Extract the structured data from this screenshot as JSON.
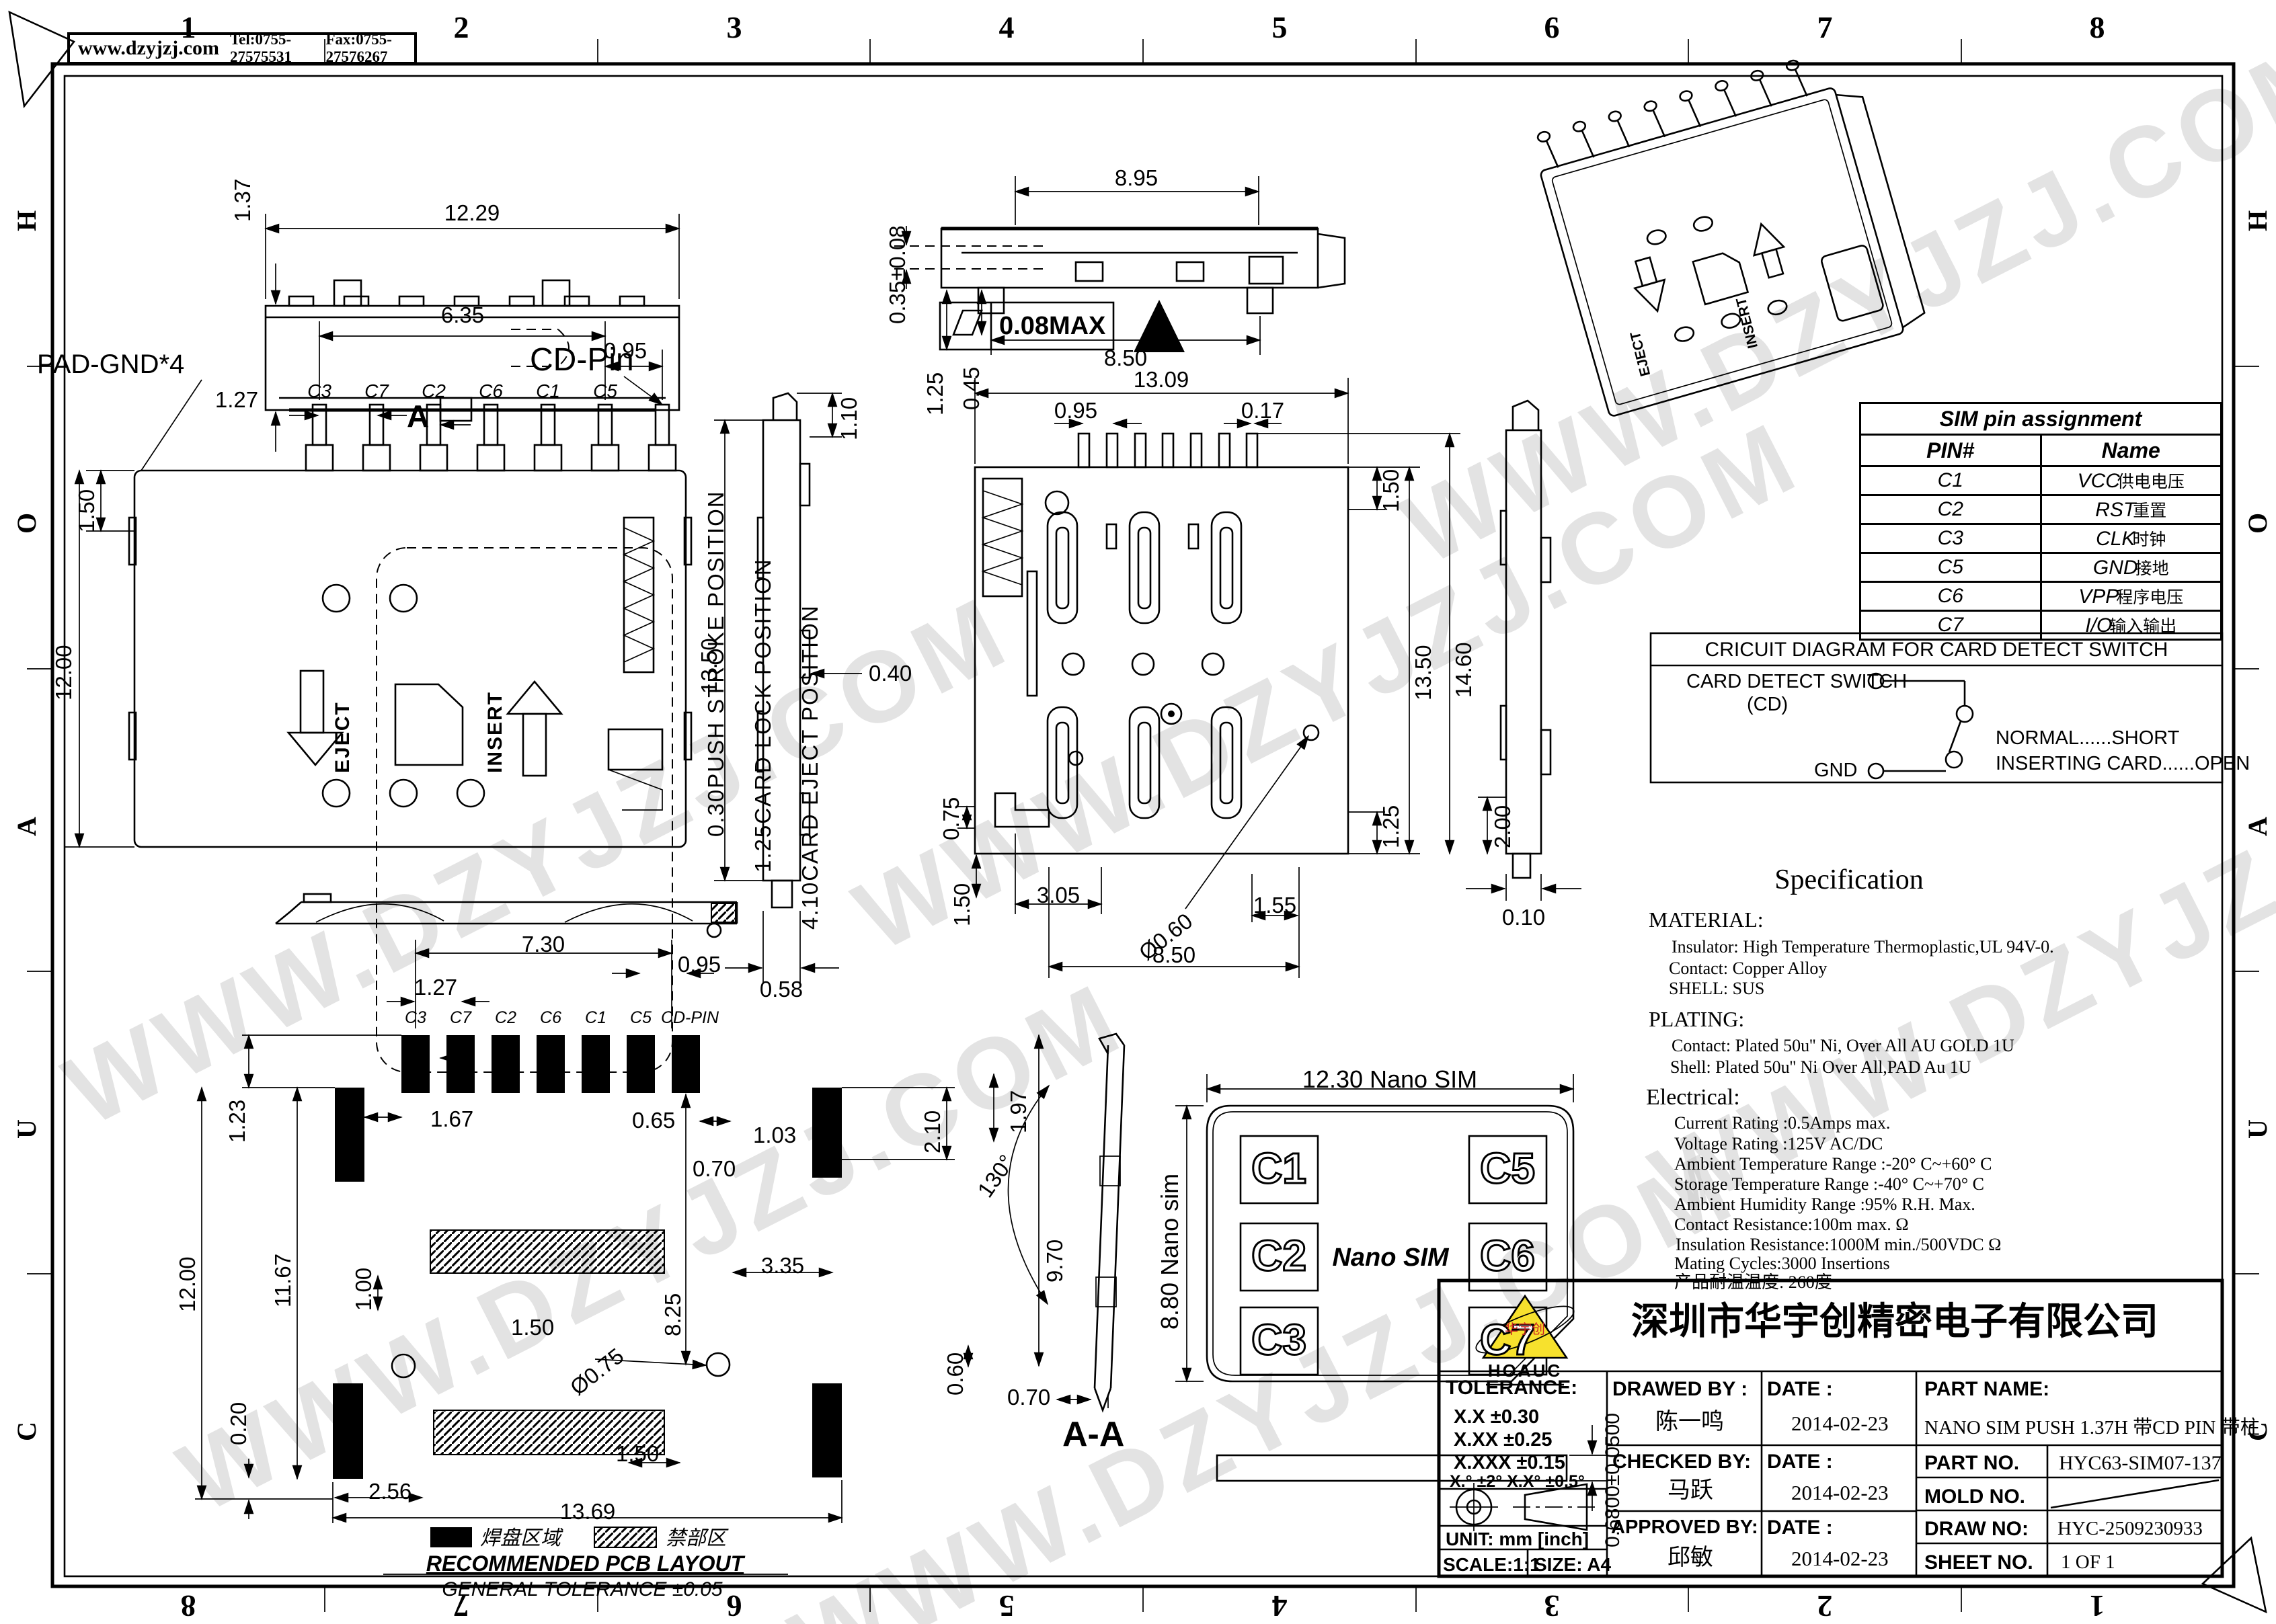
{
  "page": {
    "website": "www.dzyjzj.com",
    "tel": "Tel:0755-27575531",
    "fax": "Fax:0755-27576267",
    "watermark": "WWW.DZYJZJ.COM"
  },
  "border": {
    "cols": [
      "1",
      "2",
      "3",
      "4",
      "5",
      "6",
      "7",
      "8"
    ],
    "cols_bottom": [
      "8",
      "7",
      "6",
      "5",
      "4",
      "3",
      "2",
      "1"
    ],
    "rows": [
      "H",
      "O",
      "A",
      "U",
      "C"
    ]
  },
  "front": {
    "w": "12.29",
    "h": "1.37",
    "flatness": "0.08MAX"
  },
  "top": {
    "pad_gnd": "PAD-GND*4",
    "cd_pin": "CD-Pin",
    "d635": "6.35",
    "d095": "0.95",
    "d127": "1.27",
    "d150": "1.50",
    "d1200": "12.00",
    "pins": [
      "C3",
      "C7",
      "C2",
      "C6",
      "C1",
      "C5"
    ],
    "eject": "EJECT",
    "insert": "INSERT",
    "section": "A",
    "pos": [
      "0.30PUSH STROKE POSITION",
      "1.25CARD LOCK POSITION",
      "4.10CARD EJECT POSITION"
    ]
  },
  "sideL": {
    "d1350": "13.50",
    "d058": "0.58",
    "d110": "1.10",
    "d040": "0.40"
  },
  "frontM": {
    "d895": "8.95",
    "d850": "8.50",
    "d035": "0.35±0.08",
    "d125": "1.25",
    "d045": "0.45"
  },
  "bottom": {
    "d1309": "13.09",
    "d095": "0.95",
    "d017": "0.17",
    "d150t": "1.50",
    "d1350": "13.50",
    "d1460": "14.60",
    "d125": "1.25",
    "d200": "2.00",
    "d075": "0.75",
    "d150b": "1.50",
    "d305": "3.05",
    "d060": "Ø0.60",
    "d850": "8.50",
    "d155": "1.55",
    "d010": "0.10"
  },
  "pcb": {
    "d730": "7.30",
    "d095": "0.95",
    "d127": "1.27",
    "pins": [
      "C3",
      "C7",
      "C2",
      "C6",
      "C1",
      "C5",
      "CD-PIN"
    ],
    "d123": "1.23",
    "d1167": "11.67",
    "d1200": "12.00",
    "d020": "0.20",
    "d167": "1.67",
    "d065": "0.65",
    "d103": "1.03",
    "d210": "2.10",
    "d197": "1.97",
    "d070": "0.70",
    "d100": "1.00",
    "d335": "3.35",
    "d825": "8.25",
    "d970": "9.70",
    "d075": "Ø0.75",
    "d150a": "1.50",
    "d060": "0.60",
    "d256": "2.56",
    "d150b": "1.50",
    "d1369": "13.69",
    "legend_pad": "焊盘区域",
    "legend_keepout": "禁部区",
    "title": "RECOMMENDED PCB LAYOUT",
    "tol": "GENERAL TOLERANCE ±0.05"
  },
  "section": {
    "angle": "130°",
    "d070": "0.70",
    "label": "A-A"
  },
  "sim": {
    "w": "12.30 Nano SIM",
    "h": "8.80 Nano sim",
    "center": "Nano SIM",
    "left": [
      "C1",
      "C2",
      "C3"
    ],
    "right": [
      "C5",
      "C6",
      "C7"
    ],
    "thick": "0.6800±0.0500"
  },
  "pin_table": {
    "title": "SIM pin assignment",
    "col_pin": "PIN#",
    "col_name": "Name",
    "rows": [
      {
        "pin": "C1",
        "name": "VCC",
        "cn": "供电电压"
      },
      {
        "pin": "C2",
        "name": "RST",
        "cn": "重置"
      },
      {
        "pin": "C3",
        "name": "CLK",
        "cn": "时钟"
      },
      {
        "pin": "C5",
        "name": "GND",
        "cn": "接地"
      },
      {
        "pin": "C6",
        "name": "VPP",
        "cn": "程序电压"
      },
      {
        "pin": "C7",
        "name": "I/O",
        "cn": "输入输出"
      }
    ]
  },
  "circuit": {
    "title": "CRICUIT DIAGRAM FOR CARD DETECT SWITCH",
    "sw": "CARD DETECT SWITCH",
    "cd": "(CD)",
    "gnd": "GND",
    "normal": "NORMAL......SHORT",
    "inserting": "INSERTING CARD......OPEN"
  },
  "spec": {
    "title": "Specification",
    "material_h": "MATERIAL:",
    "material": [
      "Insulator: High Temperature Thermoplastic,UL 94V-0.",
      "Contact: Copper Alloy",
      "SHELL: SUS"
    ],
    "plating_h": "PLATING:",
    "plating": [
      "Contact: Plated 50u'' Ni, Over All AU GOLD 1U",
      "Shell: Plated 50u'' Ni Over All,PAD Au 1U"
    ],
    "electrical_h": "Electrical:",
    "electrical": [
      "Current Rating :0.5Amps max.",
      "Voltage Rating :125V AC/DC",
      "Ambient Temperature Range :-20° C~+60° C",
      "Storage Temperature Range :-40° C~+70° C",
      "Ambient Humidity Range :95% R.H. Max.",
      "Contact Resistance:100m  max. Ω",
      "Insulation Resistance:1000M  min./500VDC Ω",
      "Mating Cycles:3000 Insertions",
      "产品耐温温度: 260度"
    ]
  },
  "tb": {
    "company": "深圳市华宇创精密电子有限公司",
    "logo": "HOAUC",
    "logo_cn": "华宇创",
    "tol_h": "TOLERANCE:",
    "tol1": "X.X      ±0.30",
    "tol2": "X.XX    ±0.25",
    "tol3": "X.XXX  ±0.15",
    "tol4": "X.°  ±2°       X.X°  ±0.5°",
    "unit": "UNIT:  mm  [inch]",
    "scale": "SCALE:1:1",
    "size": "SIZE:  A4",
    "drawed": "DRAWED BY :",
    "checked": "CHECKED BY:",
    "approved": "APPROVED BY:",
    "date": "DATE :",
    "drawer": "陈一鸣",
    "checker": "马跃",
    "approver": "邱敏",
    "date1": "2014-02-23",
    "date2": "2014-02-23",
    "date3": "2014-02-23",
    "pn_h": "PART NAME:",
    "pn": "NANO SIM PUSH 1.37H 带CD PIN 带柱",
    "pno_h": "PART NO.",
    "pno": "HYC63-SIM07-137",
    "mold_h": "MOLD NO.",
    "dno_h": "DRAW NO:",
    "dno": "HYC-2509230933",
    "sheet_h": "SHEET NO.",
    "sheet": "1 OF 1"
  }
}
